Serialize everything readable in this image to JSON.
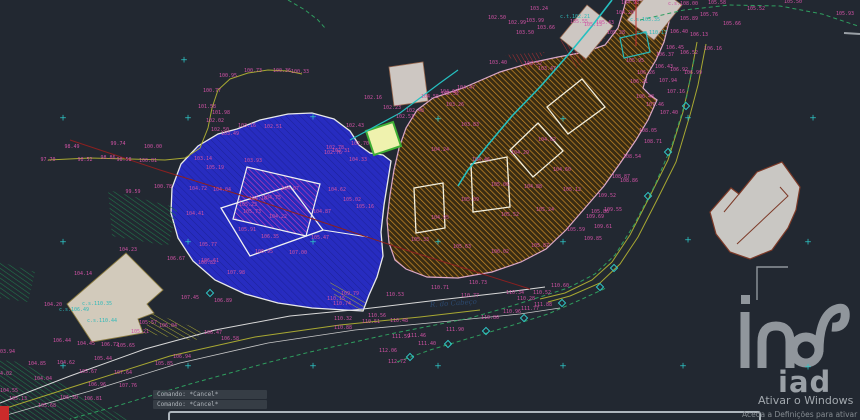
{
  "canvas": {
    "width": 860,
    "height": 420,
    "background": "#222831"
  },
  "command_panel": {
    "lines": [
      "Comando: *Cancel*",
      "Comando: *Cancel*"
    ]
  },
  "activation": {
    "line1": "Ativar o Windows",
    "line2": "Aceda a Definições para ativar o Windows."
  },
  "logo": {
    "text": "iad"
  },
  "road_label": {
    "text": "R. do Cabeço",
    "x": 430,
    "y": 301,
    "rot": -4
  },
  "colors": {
    "background": "#222831",
    "parcel_a_fill": "#272cc0",
    "parcel_b_hatch": "#c98a28",
    "label_magenta": "#cf52a4",
    "label_cyan": "#2fb9b9",
    "contour_green": "#2f9e5f",
    "road_olive": "#a8a832",
    "grid_cross_cyan": "#2ec6c6",
    "building_gray": "#cdc7c2",
    "watermark_gray": "#9aa0a6"
  },
  "crosses": [
    [
      63,
      119
    ],
    [
      188,
      119
    ],
    [
      313,
      118
    ],
    [
      438,
      120
    ],
    [
      563,
      120
    ],
    [
      688,
      119
    ],
    [
      813,
      119
    ],
    [
      63,
      243
    ],
    [
      188,
      243
    ],
    [
      313,
      243
    ],
    [
      438,
      243
    ],
    [
      563,
      243
    ],
    [
      688,
      241
    ],
    [
      808,
      243
    ],
    [
      63,
      367
    ],
    [
      188,
      367
    ],
    [
      313,
      367
    ],
    [
      438,
      367
    ],
    [
      563,
      367
    ],
    [
      683,
      367
    ],
    [
      808,
      368
    ],
    [
      184,
      61
    ]
  ],
  "diamonds": [
    [
      410,
      357
    ],
    [
      448,
      344
    ],
    [
      486,
      331
    ],
    [
      524,
      318
    ],
    [
      562,
      303
    ],
    [
      600,
      287
    ],
    [
      614,
      268
    ],
    [
      648,
      196
    ],
    [
      668,
      152
    ],
    [
      686,
      106
    ],
    [
      210,
      293
    ]
  ],
  "labels": [
    {
      "x": 48,
      "y": 160,
      "t": "97.70"
    },
    {
      "x": 72,
      "y": 147,
      "t": "98.49"
    },
    {
      "x": 85,
      "y": 160,
      "t": "98.52"
    },
    {
      "x": 108,
      "y": 158,
      "t": "98.86"
    },
    {
      "x": 124,
      "y": 160,
      "t": "98.58"
    },
    {
      "x": 118,
      "y": 144,
      "t": "99.74"
    },
    {
      "x": 153,
      "y": 147,
      "t": "100.00"
    },
    {
      "x": 148,
      "y": 161,
      "t": "100.81"
    },
    {
      "x": 133,
      "y": 192,
      "t": "99.59"
    },
    {
      "x": 163,
      "y": 187,
      "t": "100.78"
    },
    {
      "x": 228,
      "y": 76,
      "t": "100.95"
    },
    {
      "x": 253,
      "y": 71,
      "t": "100.73"
    },
    {
      "x": 282,
      "y": 71,
      "t": "100.36"
    },
    {
      "x": 300,
      "y": 72,
      "t": "100.33"
    },
    {
      "x": 212,
      "y": 91,
      "t": "100.77"
    },
    {
      "x": 207,
      "y": 107,
      "t": "101.58"
    },
    {
      "x": 221,
      "y": 113,
      "t": "101.98"
    },
    {
      "x": 215,
      "y": 121,
      "t": "102.02"
    },
    {
      "x": 220,
      "y": 130,
      "t": "102.50"
    },
    {
      "x": 373,
      "y": 98,
      "t": "102.16"
    },
    {
      "x": 392,
      "y": 108,
      "t": "102.23"
    },
    {
      "x": 415,
      "y": 111,
      "t": "102.48"
    },
    {
      "x": 405,
      "y": 117,
      "t": "102.53"
    },
    {
      "x": 355,
      "y": 126,
      "t": "102.43"
    },
    {
      "x": 360,
      "y": 144,
      "t": "102.70"
    },
    {
      "x": 341,
      "y": 151,
      "t": "102.31"
    },
    {
      "x": 333,
      "y": 153,
      "t": "102.76"
    },
    {
      "x": 430,
      "y": 97,
      "t": "104.55"
    },
    {
      "x": 449,
      "y": 92,
      "t": "104.60"
    },
    {
      "x": 466,
      "y": 88,
      "t": "104.47"
    },
    {
      "x": 539,
      "y": 9,
      "t": "103.24"
    },
    {
      "x": 517,
      "y": 23,
      "t": "102.99"
    },
    {
      "x": 535,
      "y": 21,
      "t": "103.99"
    },
    {
      "x": 497,
      "y": 18,
      "t": "102.50"
    },
    {
      "x": 525,
      "y": 33,
      "t": "103.50"
    },
    {
      "x": 546,
      "y": 28,
      "t": "103.66"
    },
    {
      "x": 593,
      "y": 25,
      "t": "105.13"
    },
    {
      "x": 605,
      "y": 23,
      "t": "105.43"
    },
    {
      "x": 625,
      "y": 13,
      "t": "104.20"
    },
    {
      "x": 630,
      "y": 3,
      "t": "104.93"
    },
    {
      "x": 616,
      "y": 33,
      "t": "105.28"
    },
    {
      "x": 579,
      "y": 22,
      "t": "105.55"
    },
    {
      "x": 635,
      "y": 61,
      "t": "105.95"
    },
    {
      "x": 683,
      "y": 4,
      "t": "c.s.108.00"
    },
    {
      "x": 645,
      "y": 20,
      "t": "c.s.103.35",
      "c": "c"
    },
    {
      "x": 652,
      "y": 33,
      "t": "c.s.110.17",
      "c": "c"
    },
    {
      "x": 575,
      "y": 17,
      "t": "c.t.102.21",
      "c": "c"
    },
    {
      "x": 97,
      "y": 304,
      "t": "c.s.110.35",
      "c": "c"
    },
    {
      "x": 74,
      "y": 310,
      "t": "c.s.106.49",
      "c": "c"
    },
    {
      "x": 102,
      "y": 321,
      "t": "c.s.110.44",
      "c": "c"
    },
    {
      "x": 717,
      "y": 3,
      "t": "105.58"
    },
    {
      "x": 709,
      "y": 15,
      "t": "105.76"
    },
    {
      "x": 756,
      "y": 9,
      "t": "105.52"
    },
    {
      "x": 793,
      "y": 2,
      "t": "105.50"
    },
    {
      "x": 845,
      "y": 14,
      "t": "105.93"
    },
    {
      "x": 732,
      "y": 24,
      "t": "105.66"
    },
    {
      "x": 689,
      "y": 19,
      "t": "105.89"
    },
    {
      "x": 679,
      "y": 32,
      "t": "106.40"
    },
    {
      "x": 699,
      "y": 35,
      "t": "106.13"
    },
    {
      "x": 713,
      "y": 49,
      "t": "106.16"
    },
    {
      "x": 675,
      "y": 48,
      "t": "106.45"
    },
    {
      "x": 665,
      "y": 55,
      "t": "106.37"
    },
    {
      "x": 689,
      "y": 53,
      "t": "106.52"
    },
    {
      "x": 664,
      "y": 67,
      "t": "106.43"
    },
    {
      "x": 679,
      "y": 70,
      "t": "106.92"
    },
    {
      "x": 693,
      "y": 73,
      "t": "106.99"
    },
    {
      "x": 646,
      "y": 73,
      "t": "106.26"
    },
    {
      "x": 639,
      "y": 82,
      "t": "106.21"
    },
    {
      "x": 668,
      "y": 81,
      "t": "107.94"
    },
    {
      "x": 676,
      "y": 92,
      "t": "107.16"
    },
    {
      "x": 645,
      "y": 97,
      "t": "106.48"
    },
    {
      "x": 669,
      "y": 113,
      "t": "107.40"
    },
    {
      "x": 655,
      "y": 105,
      "t": "107.46"
    },
    {
      "x": 648,
      "y": 131,
      "t": "108.05"
    },
    {
      "x": 653,
      "y": 142,
      "t": "108.71"
    },
    {
      "x": 632,
      "y": 157,
      "t": "108.54"
    },
    {
      "x": 621,
      "y": 177,
      "t": "108.87"
    },
    {
      "x": 629,
      "y": 181,
      "t": "108.86"
    },
    {
      "x": 607,
      "y": 196,
      "t": "109.52"
    },
    {
      "x": 613,
      "y": 210,
      "t": "109.55"
    },
    {
      "x": 595,
      "y": 217,
      "t": "109.69"
    },
    {
      "x": 603,
      "y": 227,
      "t": "109.61"
    },
    {
      "x": 593,
      "y": 239,
      "t": "109.85"
    },
    {
      "x": 247,
      "y": 126,
      "t": "103.16"
    },
    {
      "x": 273,
      "y": 127,
      "t": "102.51"
    },
    {
      "x": 230,
      "y": 134,
      "t": "103.49"
    },
    {
      "x": 253,
      "y": 161,
      "t": "103.93"
    },
    {
      "x": 203,
      "y": 159,
      "t": "103.14"
    },
    {
      "x": 215,
      "y": 168,
      "t": "105.19"
    },
    {
      "x": 198,
      "y": 189,
      "t": "104.72"
    },
    {
      "x": 222,
      "y": 190,
      "t": "104.04"
    },
    {
      "x": 195,
      "y": 214,
      "t": "104.41"
    },
    {
      "x": 248,
      "y": 205,
      "t": "105.23"
    },
    {
      "x": 258,
      "y": 199,
      "t": "104.15"
    },
    {
      "x": 272,
      "y": 198,
      "t": "104.75"
    },
    {
      "x": 252,
      "y": 212,
      "t": "105.73"
    },
    {
      "x": 278,
      "y": 217,
      "t": "104.22"
    },
    {
      "x": 322,
      "y": 212,
      "t": "104.87"
    },
    {
      "x": 337,
      "y": 190,
      "t": "104.62"
    },
    {
      "x": 352,
      "y": 200,
      "t": "105.02"
    },
    {
      "x": 365,
      "y": 207,
      "t": "105.16"
    },
    {
      "x": 358,
      "y": 160,
      "t": "104.33"
    },
    {
      "x": 335,
      "y": 148,
      "t": "102.78"
    },
    {
      "x": 290,
      "y": 189,
      "t": "104.07"
    },
    {
      "x": 247,
      "y": 230,
      "t": "105.91"
    },
    {
      "x": 270,
      "y": 237,
      "t": "106.35"
    },
    {
      "x": 208,
      "y": 245,
      "t": "105.77"
    },
    {
      "x": 210,
      "y": 261,
      "t": "106.61"
    },
    {
      "x": 298,
      "y": 253,
      "t": "107.00"
    },
    {
      "x": 320,
      "y": 238,
      "t": "105.47"
    },
    {
      "x": 264,
      "y": 252,
      "t": "106.95"
    },
    {
      "x": 37,
      "y": 364,
      "t": "104.85"
    },
    {
      "x": 9,
      "y": 391,
      "t": "104.55"
    },
    {
      "x": 18,
      "y": 399,
      "t": "105.13"
    },
    {
      "x": 3,
      "y": 374,
      "t": "104.02"
    },
    {
      "x": 43,
      "y": 379,
      "t": "104.04"
    },
    {
      "x": 6,
      "y": 352,
      "t": "103.94"
    },
    {
      "x": 47,
      "y": 406,
      "t": "105.68"
    },
    {
      "x": 69,
      "y": 398,
      "t": "106.30"
    },
    {
      "x": 93,
      "y": 399,
      "t": "106.81"
    },
    {
      "x": 66,
      "y": 363,
      "t": "104.62"
    },
    {
      "x": 88,
      "y": 372,
      "t": "105.67"
    },
    {
      "x": 103,
      "y": 359,
      "t": "105.44"
    },
    {
      "x": 110,
      "y": 345,
      "t": "106.72"
    },
    {
      "x": 126,
      "y": 346,
      "t": "105.65"
    },
    {
      "x": 62,
      "y": 341,
      "t": "106.44"
    },
    {
      "x": 86,
      "y": 344,
      "t": "104.45"
    },
    {
      "x": 140,
      "y": 332,
      "t": "105.21"
    },
    {
      "x": 123,
      "y": 373,
      "t": "107.64"
    },
    {
      "x": 97,
      "y": 385,
      "t": "106.96"
    },
    {
      "x": 128,
      "y": 386,
      "t": "107.76"
    },
    {
      "x": 182,
      "y": 357,
      "t": "106.94"
    },
    {
      "x": 164,
      "y": 364,
      "t": "105.85"
    },
    {
      "x": 213,
      "y": 333,
      "t": "106.47"
    },
    {
      "x": 230,
      "y": 339,
      "t": "106.58"
    },
    {
      "x": 168,
      "y": 326,
      "t": "106.04"
    },
    {
      "x": 148,
      "y": 323,
      "t": "105.57"
    },
    {
      "x": 190,
      "y": 298,
      "t": "107.45"
    },
    {
      "x": 223,
      "y": 301,
      "t": "106.89"
    },
    {
      "x": 236,
      "y": 273,
      "t": "107.98"
    },
    {
      "x": 176,
      "y": 259,
      "t": "106.67"
    },
    {
      "x": 207,
      "y": 263,
      "t": "106.82"
    },
    {
      "x": 83,
      "y": 274,
      "t": "104.14"
    },
    {
      "x": 53,
      "y": 305,
      "t": "104.20"
    },
    {
      "x": 128,
      "y": 250,
      "t": "104.23"
    },
    {
      "x": 336,
      "y": 299,
      "t": "110.15"
    },
    {
      "x": 350,
      "y": 294,
      "t": "109.79"
    },
    {
      "x": 342,
      "y": 304,
      "t": "110.74"
    },
    {
      "x": 395,
      "y": 295,
      "t": "110.53"
    },
    {
      "x": 440,
      "y": 288,
      "t": "110.71"
    },
    {
      "x": 478,
      "y": 283,
      "t": "110.73"
    },
    {
      "x": 470,
      "y": 296,
      "t": "110.77"
    },
    {
      "x": 515,
      "y": 293,
      "t": "110.34"
    },
    {
      "x": 526,
      "y": 299,
      "t": "110.28"
    },
    {
      "x": 542,
      "y": 293,
      "t": "110.52"
    },
    {
      "x": 543,
      "y": 305,
      "t": "111.88"
    },
    {
      "x": 377,
      "y": 316,
      "t": "110.56"
    },
    {
      "x": 371,
      "y": 322,
      "t": "110.51"
    },
    {
      "x": 343,
      "y": 319,
      "t": "110.32"
    },
    {
      "x": 343,
      "y": 328,
      "t": "110.88"
    },
    {
      "x": 399,
      "y": 321,
      "t": "110.48"
    },
    {
      "x": 401,
      "y": 337,
      "t": "111.59"
    },
    {
      "x": 417,
      "y": 336,
      "t": "111.46"
    },
    {
      "x": 427,
      "y": 344,
      "t": "111.40"
    },
    {
      "x": 455,
      "y": 330,
      "t": "111.90"
    },
    {
      "x": 490,
      "y": 318,
      "t": "110.86"
    },
    {
      "x": 512,
      "y": 312,
      "t": "110.96"
    },
    {
      "x": 530,
      "y": 309,
      "t": "111.77"
    },
    {
      "x": 388,
      "y": 351,
      "t": "112.06"
    },
    {
      "x": 397,
      "y": 362,
      "t": "112.72"
    },
    {
      "x": 560,
      "y": 286,
      "t": "110.60"
    },
    {
      "x": 533,
      "y": 64,
      "t": "103.52"
    },
    {
      "x": 547,
      "y": 69,
      "t": "103.47"
    },
    {
      "x": 498,
      "y": 63,
      "t": "103.40"
    },
    {
      "x": 450,
      "y": 94,
      "t": "102.52"
    },
    {
      "x": 455,
      "y": 105,
      "t": "103.26"
    },
    {
      "x": 470,
      "y": 125,
      "t": "103.83"
    },
    {
      "x": 440,
      "y": 150,
      "t": "104.24"
    },
    {
      "x": 481,
      "y": 160,
      "t": "104.46"
    },
    {
      "x": 520,
      "y": 153,
      "t": "104.29"
    },
    {
      "x": 547,
      "y": 140,
      "t": "104.02"
    },
    {
      "x": 500,
      "y": 185,
      "t": "105.06"
    },
    {
      "x": 533,
      "y": 187,
      "t": "104.88"
    },
    {
      "x": 562,
      "y": 170,
      "t": "104.60"
    },
    {
      "x": 470,
      "y": 200,
      "t": "105.09"
    },
    {
      "x": 510,
      "y": 215,
      "t": "105.52"
    },
    {
      "x": 545,
      "y": 210,
      "t": "105.24"
    },
    {
      "x": 572,
      "y": 190,
      "t": "105.12"
    },
    {
      "x": 440,
      "y": 218,
      "t": "104.95"
    },
    {
      "x": 420,
      "y": 240,
      "t": "105.33"
    },
    {
      "x": 462,
      "y": 247,
      "t": "105.63"
    },
    {
      "x": 500,
      "y": 252,
      "t": "106.02"
    },
    {
      "x": 540,
      "y": 246,
      "t": "105.87"
    },
    {
      "x": 576,
      "y": 230,
      "t": "105.59"
    },
    {
      "x": 600,
      "y": 212,
      "t": "105.86"
    }
  ]
}
